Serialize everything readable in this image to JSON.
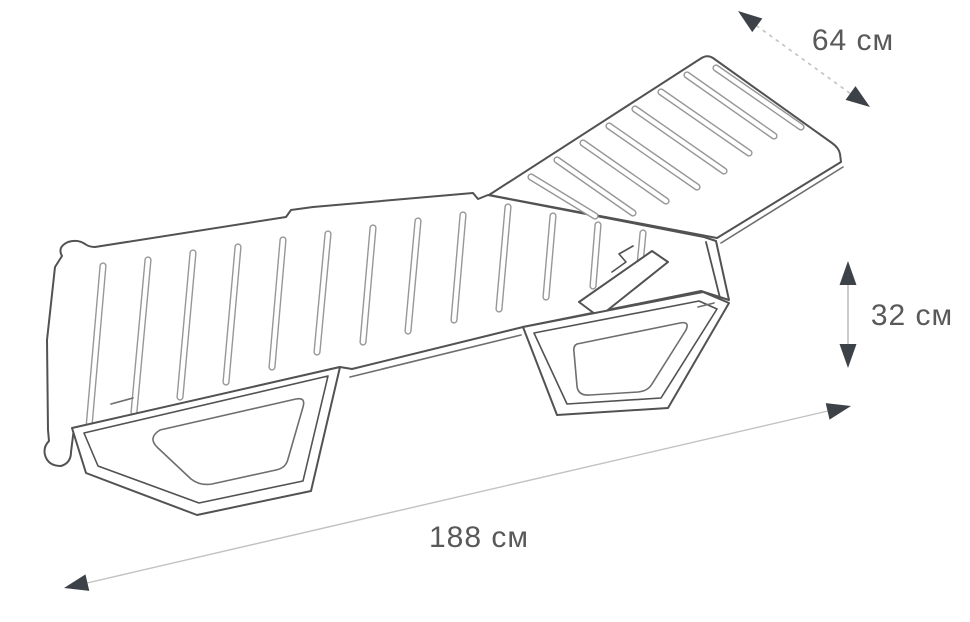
{
  "diagram": {
    "subject": "sun-lounger-line-drawing",
    "unit": "см",
    "dimensions": {
      "width": {
        "value": 64,
        "label": "64 см"
      },
      "height": {
        "value": 32,
        "label": "32 см"
      },
      "length": {
        "value": 188,
        "label": "188 см"
      }
    },
    "colors": {
      "background": "#ffffff",
      "outline": "#525252",
      "detail_line": "#6e6e6e",
      "slat_outline": "#979797",
      "dimension_line": "#c6c6c6",
      "arrowhead": "#3d4148",
      "label_text": "#595959"
    }
  }
}
